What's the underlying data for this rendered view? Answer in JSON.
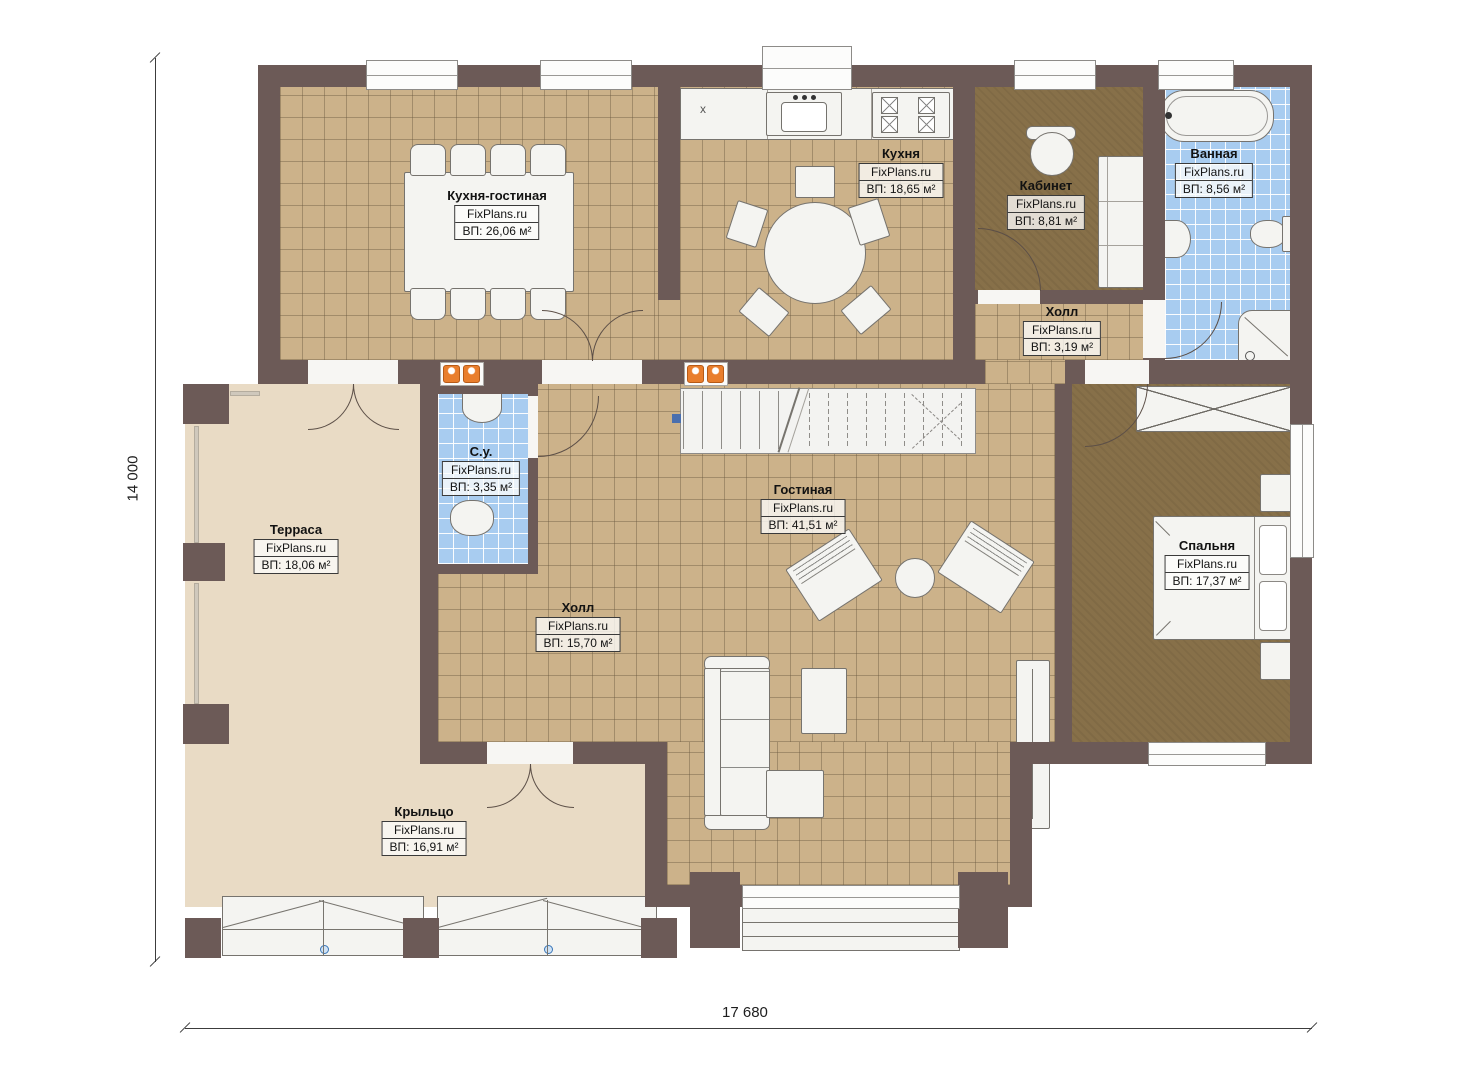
{
  "plan": {
    "brand": "FixPlans.ru",
    "dimensions": {
      "height_label": "14 000",
      "width_label": "17 680"
    },
    "kitchen": {
      "counter_mark": "x"
    },
    "rooms": [
      {
        "name": "Кухня-гостиная",
        "area": "ВП: 26,06 м²"
      },
      {
        "name": "Кухня",
        "area": "ВП: 18,65 м²"
      },
      {
        "name": "Кабинет",
        "area": "ВП: 8,81 м²"
      },
      {
        "name": "Ванная",
        "area": "ВП: 8,56 м²"
      },
      {
        "name": "Холл",
        "area": "ВП: 3,19 м²"
      },
      {
        "name": "С.у.",
        "area": "ВП: 3,35 м²"
      },
      {
        "name": "Гостиная",
        "area": "ВП: 41,51 м²"
      },
      {
        "name": "Холл",
        "area": "ВП: 15,70 м²"
      },
      {
        "name": "Терраса",
        "area": "ВП: 18,06 м²"
      },
      {
        "name": "Спальня",
        "area": "ВП: 17,37 м²"
      },
      {
        "name": "Крыльцо",
        "area": "ВП: 16,91 м²"
      }
    ],
    "colors": {
      "wall": "#6c5a57",
      "floor_tile": "#ccb28a",
      "bath_tile": "#a8ccf0",
      "carpet": "#877049",
      "deck": "#e9dbc5",
      "radiator": "#e97e2d"
    }
  }
}
